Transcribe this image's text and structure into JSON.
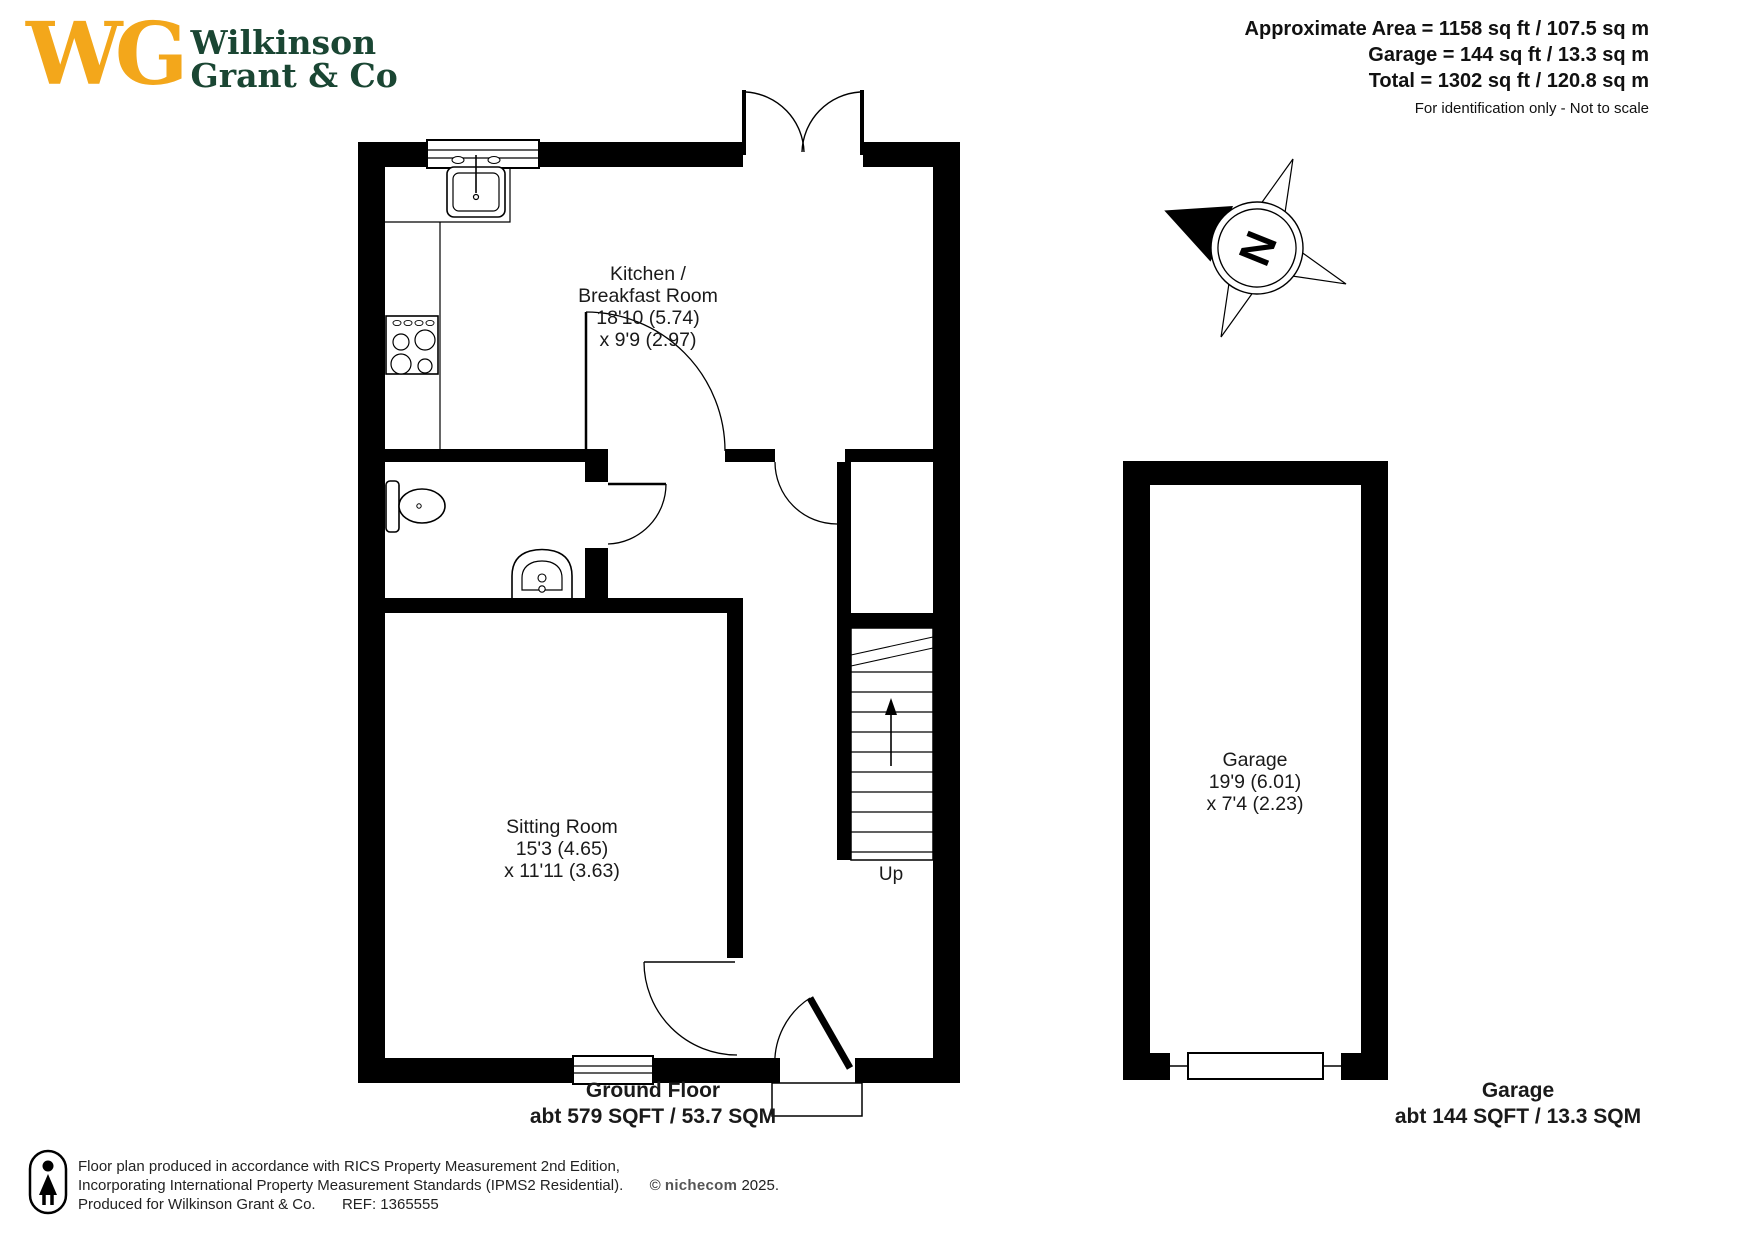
{
  "logo": {
    "monogram": "WG",
    "name_line1": "Wilkinson",
    "name_line2": "Grant & Co"
  },
  "area_summary": {
    "line1": "Approximate Area = 1158 sq ft / 107.5 sq m",
    "line2": "Garage = 144 sq ft / 13.3 sq m",
    "line3": "Total = 1302 sq ft / 120.8 sq m",
    "disclaimer": "For identification only - Not to scale"
  },
  "compass": {
    "north_label": "N"
  },
  "rooms": {
    "kitchen": {
      "lines": [
        "Kitchen /",
        "Breakfast Room",
        "18'10 (5.74)",
        "x 9'9 (2.97)"
      ]
    },
    "sitting_room": {
      "lines": [
        "Sitting Room",
        "15'3 (4.65)",
        "x 11'11 (3.63)"
      ]
    },
    "garage": {
      "lines": [
        "Garage",
        "19'9 (6.01)",
        "x 7'4 (2.23)"
      ]
    }
  },
  "stairs": {
    "label": "Up"
  },
  "floor_labels": {
    "ground": {
      "title": "Ground Floor",
      "area": "abt 579 SQFT / 53.7 SQM"
    },
    "garage": {
      "title": "Garage",
      "area": "abt 144 SQFT / 13.3 SQM"
    }
  },
  "footer": {
    "line1": "Floor plan produced in accordance with RICS Property Measurement 2nd Edition,",
    "line2_prefix": "Incorporating International Property Measurement Standards (IPMS2 Residential).",
    "copyright": "©",
    "brand": "nichecom",
    "year": "2025.",
    "produced_for": "Produced for Wilkinson Grant & Co.",
    "ref": "REF: 1365555"
  },
  "colors": {
    "logo_gold": "#F3A71B",
    "logo_green": "#1A4633",
    "wall_black": "#000000"
  }
}
